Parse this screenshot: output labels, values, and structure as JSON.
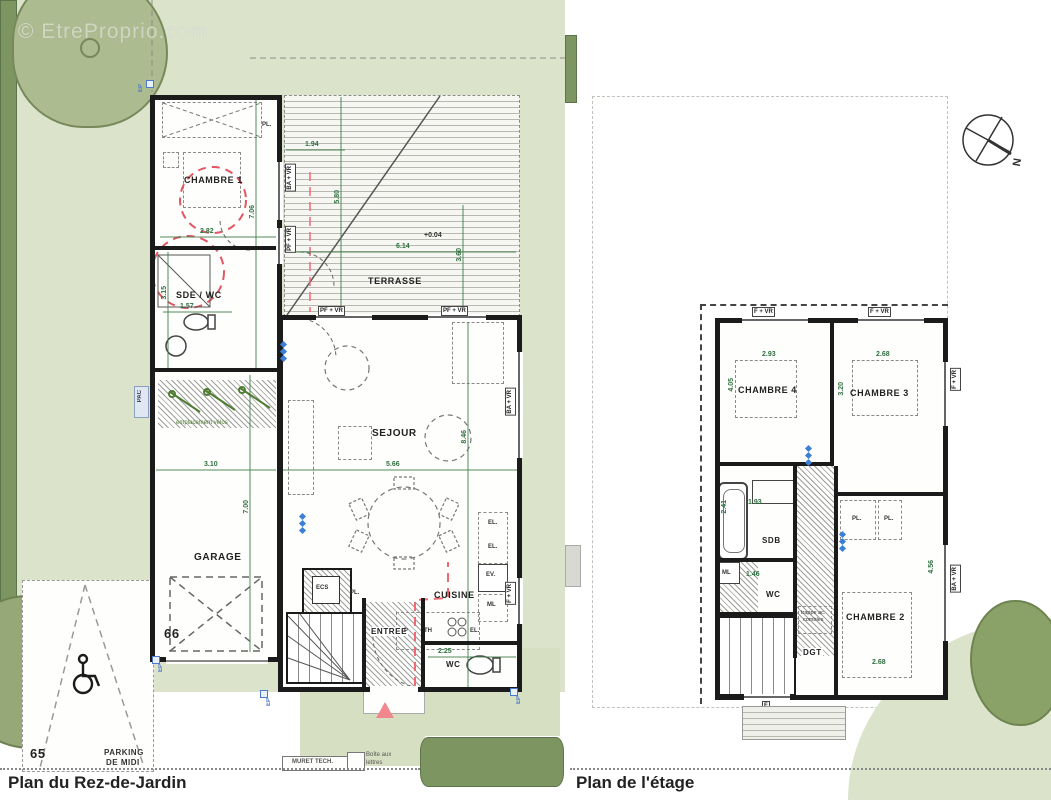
{
  "watermark": "© EtreProprio.com",
  "ground_floor": {
    "title": "Plan du Rez-de-Jardin",
    "lot_number": "66",
    "neighbor_lot_number": "65",
    "parking_line1": "PARKING",
    "parking_line2": "DE MIDI",
    "rooms": {
      "chambre1": "CHAMBRE 1",
      "sde_wc": "SDE / WC",
      "terrasse": "TERRASSE",
      "sejour": "SEJOUR",
      "garage": "GARAGE",
      "cuisine": "CUISINE",
      "entree": "ENTREE",
      "wc": "WC"
    },
    "dims": {
      "chambre1_w": "2.82",
      "chambre1_h": "7.06",
      "sde_w": "1.57",
      "sde_h": "3.15",
      "terrasse_w1": "1.94",
      "terrasse_h1": "5.80",
      "terrasse_w2": "6.14",
      "terrasse_h2": "3.60",
      "terrasse_level": "+0.04",
      "garage_w": "3.10",
      "garage_h": "7.00",
      "sejour_w": "5.66",
      "sejour_h": "8.46",
      "cuisine_w": "2.25"
    },
    "tags": {
      "chambre1_window": "BA + VR",
      "chambre1_door": "PF + VR",
      "sejour_top_window1": "PF + VR",
      "sejour_top_window2": "PF + VR",
      "sejour_right_window": "BA + VR",
      "cuisine_window": "F + VR"
    },
    "annotations": {
      "closet": "PL.",
      "ecs": "ECS",
      "bike_area": "emplacement vélos",
      "muret": "MURET TECH.",
      "mailbox_line1": "Boîte aux",
      "mailbox_line2": "lettres",
      "pac": "PAC",
      "ep": "EP",
      "appliance_p": "P",
      "appliance_th": "TH",
      "appliance_el": "EL.",
      "appliance_ev": "EV.",
      "appliance_ml": "ML"
    }
  },
  "upper_floor": {
    "title": "Plan de l'étage",
    "compass": "N",
    "rooms": {
      "chambre4": "CHAMBRE 4",
      "chambre3": "CHAMBRE 3",
      "chambre2": "CHAMBRE 2",
      "sdb": "SDB",
      "wc": "WC",
      "dgt": "DGT"
    },
    "dims": {
      "chambre4_w": "2.93",
      "chambre4_h": "4.05",
      "chambre3_w": "2.68",
      "chambre3_h": "3.20",
      "chambre2_w": "2.68",
      "chambre2_h": "4.56",
      "sdb_w": "1.93",
      "sdb_h": "2.41",
      "wc_w": "1.46"
    },
    "tags": {
      "window_top_left": "F + VR",
      "window_top_right": "F + VR",
      "window_right_upper": "F + VR",
      "window_right_lower": "BA + VR",
      "door_bottom": "F"
    },
    "annotations": {
      "trappe_line1": "trappe ac.",
      "trappe_line2": "combles",
      "ml": "ML",
      "closet1": "PL.",
      "closet2": "PL."
    }
  }
}
